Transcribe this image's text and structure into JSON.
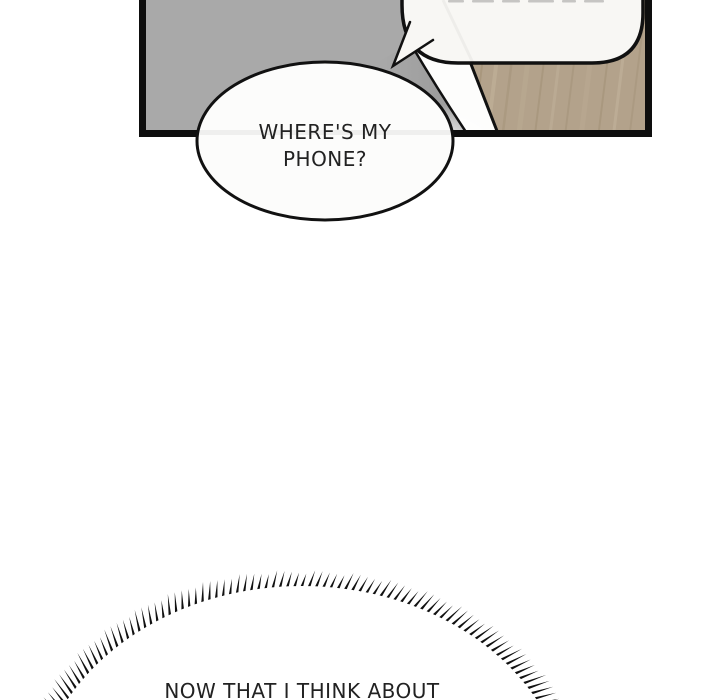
{
  "comic": {
    "panel": {
      "bg_color": "#a9a9a9",
      "shadow_gray": "#9e9e9e",
      "wood_color": "#b3a28b",
      "outline_color": "#111111",
      "bubble_fill": "#f8f7f4"
    },
    "bubbles": {
      "phone": {
        "lines": [
          "WHERE'S MY",
          "PHONE?"
        ]
      },
      "burst": {
        "text": "NOW THAT I THINK ABOUT"
      }
    },
    "text_color": "#222222"
  }
}
